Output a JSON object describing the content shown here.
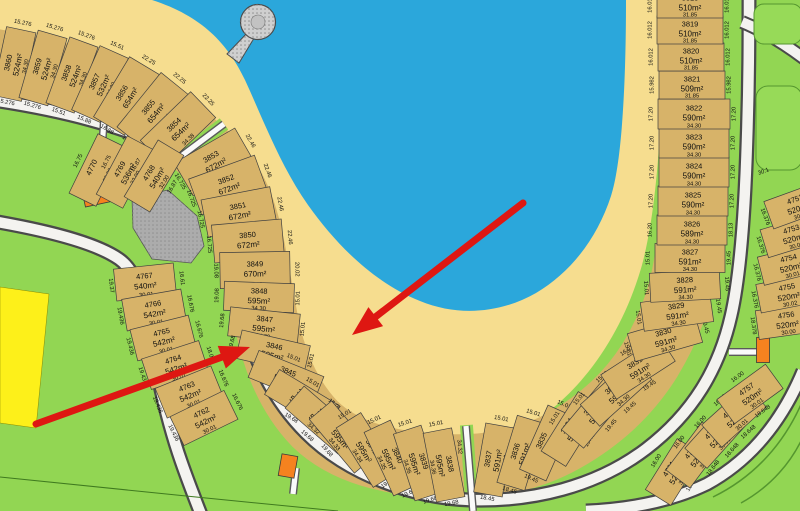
{
  "colors": {
    "lake": "#2BA7DB",
    "sand": "#F6DD8F",
    "lot_fill": "#D7B369",
    "grass": "#92D653",
    "road": "#F4F3F0",
    "road_casing": "#4A4A4A",
    "reserve_gray": "#ACACAC",
    "building_orange": "#F5821F",
    "stage_yellow": "#FDF01A",
    "annotation_red": "#DE1712",
    "text": "#101010"
  },
  "map": {
    "lots": [
      {
        "id": "3860",
        "area": "524m²",
        "dim": "34.30",
        "front": "15.276",
        "rear": "15.276",
        "x": 14,
        "y": 64,
        "r": -78,
        "w": 70,
        "h": 30,
        "fs": "r"
      },
      {
        "id": "3859",
        "area": "524m²",
        "dim": "34.30",
        "front": "15.276",
        "rear": "15.276",
        "x": 43,
        "y": 68,
        "r": -74,
        "w": 70,
        "h": 30,
        "fs": "r"
      },
      {
        "id": "3858",
        "area": "524m²",
        "dim": "34.30",
        "front": "15.276",
        "rear": "15.51",
        "x": 72,
        "y": 75,
        "r": -70,
        "w": 70,
        "h": 30,
        "fs": "r"
      },
      {
        "id": "3857",
        "area": "532m²",
        "dim": "34.30",
        "front": "15.51",
        "rear": "15.88",
        "x": 100,
        "y": 84,
        "r": -66,
        "w": 70,
        "h": 31,
        "fs": "r"
      },
      {
        "id": "3856",
        "area": "654m²",
        "dim": "34.31",
        "front": "22.25",
        "rear": "16.88",
        "x": 127,
        "y": 96,
        "r": -59,
        "w": 70,
        "h": 36,
        "fs": "r"
      },
      {
        "id": "3855",
        "area": "654m²",
        "dim": "34.34",
        "front": "22.25",
        "rear": "16.88",
        "x": 153,
        "y": 111,
        "r": -51,
        "w": 70,
        "h": 36,
        "fs": "r"
      },
      {
        "id": "3854",
        "area": "654m²",
        "dim": "34.38",
        "front": "22.25",
        "rear": "16.88",
        "x": 178,
        "y": 129,
        "r": -44,
        "w": 70,
        "h": 36,
        "fs": "r"
      },
      {
        "id": "3853",
        "area": "672m²",
        "dim": "34.30",
        "front": "22.46",
        "rear": "16.725",
        "x": 214,
        "y": 162,
        "r": -30,
        "w": 70,
        "h": 38,
        "fs": "r"
      },
      {
        "id": "3852",
        "area": "672m²",
        "dim": "34.30",
        "front": "22.46",
        "rear": "16.725",
        "x": 228,
        "y": 185,
        "r": -20,
        "w": 70,
        "h": 38,
        "fs": "r"
      },
      {
        "id": "3851",
        "area": "672m²",
        "dim": "34.30",
        "front": "22.46",
        "rear": "16.725",
        "x": 239,
        "y": 212,
        "r": -11,
        "w": 70,
        "h": 38,
        "fs": "r"
      },
      {
        "id": "3850",
        "area": "672m²",
        "dim": "34.30",
        "front": "22.46",
        "rear": "16.725",
        "x": 248,
        "y": 241,
        "r": -5,
        "w": 70,
        "h": 38,
        "fs": "r"
      },
      {
        "id": "3849",
        "area": "670m²",
        "dim": "34.30",
        "front": "20.02",
        "rear": "19.08",
        "x": 255,
        "y": 270,
        "r": -1,
        "w": 70,
        "h": 36,
        "fs": "r"
      },
      {
        "id": "3848",
        "area": "595m²",
        "dim": "34.30",
        "front": "15.01",
        "rear": "19.08",
        "x": 259,
        "y": 297,
        "r": 2,
        "w": 70,
        "h": 29,
        "fs": "r"
      },
      {
        "id": "3847",
        "area": "595m²",
        "dim": "34.30",
        "front": "15.01",
        "rear": "19.68",
        "x": 264,
        "y": 325,
        "r": 6,
        "w": 70,
        "h": 29,
        "fs": "r"
      },
      {
        "id": "3846",
        "area": "595m²",
        "dim": "34.31",
        "front": "15.01",
        "rear": "19.68",
        "x": 273,
        "y": 352,
        "r": 13,
        "w": 70,
        "h": 29,
        "fs": "r"
      },
      {
        "id": "3845",
        "area": "595m²",
        "dim": "34.31",
        "front": "15.01",
        "rear": "19.68",
        "x": 286,
        "y": 377,
        "r": 22,
        "w": 70,
        "h": 29,
        "fs": "t"
      },
      {
        "id": "3844",
        "area": "595m²",
        "dim": "34.31",
        "front": "15.01",
        "rear": "19.68",
        "x": 302,
        "y": 400,
        "r": 31,
        "w": 70,
        "h": 29,
        "fs": "t"
      },
      {
        "id": "3843",
        "area": "595m²",
        "dim": "34.32",
        "front": "15.01",
        "rear": "19.68",
        "x": 321,
        "y": 420,
        "r": 41,
        "w": 70,
        "h": 29,
        "fs": "t"
      },
      {
        "id": "3842",
        "area": "595m²",
        "dim": "34.33",
        "front": "15.01",
        "rear": "19.68",
        "x": 343,
        "y": 437,
        "r": 50,
        "w": 70,
        "h": 29,
        "fs": "t"
      },
      {
        "id": "3841",
        "area": "595m²",
        "dim": "34.34",
        "front": "15.01",
        "rear": "19.68",
        "x": 367,
        "y": 450,
        "r": 58,
        "w": 70,
        "h": 29,
        "fs": "l"
      },
      {
        "id": "3840",
        "area": "595m²",
        "dim": "34.35",
        "front": "15.01",
        "rear": "19.68",
        "x": 392,
        "y": 458,
        "r": 65,
        "w": 70,
        "h": 29,
        "fs": "l"
      },
      {
        "id": "3839",
        "area": "595m²",
        "dim": "34.36",
        "front": "15.01",
        "rear": "19.68",
        "x": 418,
        "y": 463,
        "r": 72,
        "w": 70,
        "h": 29,
        "fs": "l"
      },
      {
        "id": "3838",
        "area": "595m²",
        "dim": "34.36",
        "front": "15.01",
        "rear": "19.68",
        "x": 444,
        "y": 465,
        "r": 79,
        "w": 70,
        "h": 29,
        "fs": "l"
      },
      {
        "id": "3837",
        "area": "591m²",
        "dim": "34.30",
        "front": "15.01",
        "rear": "18.45",
        "x": 494,
        "y": 460,
        "r": -80,
        "w": 70,
        "h": 29,
        "fs": "r"
      },
      {
        "id": "3836",
        "area": "591m²",
        "dim": "34.30",
        "front": "15.01",
        "rear": "18.45",
        "x": 521,
        "y": 453,
        "r": -73,
        "w": 70,
        "h": 29,
        "fs": "r"
      },
      {
        "id": "3835",
        "area": "591m²",
        "dim": "34.30",
        "front": "15.01",
        "rear": "19.45",
        "x": 547,
        "y": 443,
        "r": -66,
        "w": 70,
        "h": 29,
        "fs": "r"
      },
      {
        "id": "3834",
        "area": "591m²",
        "dim": "34.30",
        "front": "15.01",
        "rear": "19.45",
        "x": 572,
        "y": 429,
        "r": -58,
        "w": 70,
        "h": 29,
        "fs": "t"
      },
      {
        "id": "3833",
        "area": "591m²",
        "dim": "34.30",
        "front": "15.01",
        "rear": "19.45",
        "x": 595,
        "y": 412,
        "r": -50,
        "w": 70,
        "h": 29,
        "fs": "t"
      },
      {
        "id": "3832",
        "area": "591m²",
        "dim": "34.30",
        "front": "15.01",
        "rear": "19.45",
        "x": 616,
        "y": 392,
        "r": -42,
        "w": 70,
        "h": 29,
        "fs": "t"
      },
      {
        "id": "3831",
        "area": "591m²",
        "dim": "34.30",
        "front": "16.01",
        "rear": "19.45",
        "x": 638,
        "y": 368,
        "r": -33,
        "w": 70,
        "h": 29,
        "fs": "t"
      },
      {
        "id": "3830",
        "area": "591m²",
        "dim": "34.30",
        "front": "15.01",
        "rear": "19.45",
        "x": 665,
        "y": 338,
        "r": -16,
        "w": 70,
        "h": 29,
        "fs": "l"
      },
      {
        "id": "3829",
        "area": "591m²",
        "dim": "34.30",
        "front": "15.01",
        "rear": "19.45",
        "x": 677,
        "y": 312,
        "r": -8,
        "w": 70,
        "h": 29,
        "fs": "l"
      },
      {
        "id": "3828",
        "area": "591m²",
        "dim": "34.30",
        "front": "15.01",
        "rear": "19.45",
        "x": 685,
        "y": 286,
        "r": -3,
        "w": 70,
        "h": 29,
        "fs": "l"
      },
      {
        "id": "3827",
        "area": "591m²",
        "dim": "34.30",
        "front": "15.01",
        "rear": "19.45",
        "x": 690,
        "y": 258,
        "r": 0,
        "w": 70,
        "h": 29,
        "fs": "l"
      },
      {
        "id": "3826",
        "area": "589m²",
        "dim": "34.30",
        "front": "16.20",
        "rear": "18.13",
        "x": 692,
        "y": 230,
        "r": 0,
        "w": 70,
        "h": 30,
        "fs": "l"
      },
      {
        "id": "3825",
        "area": "590m²",
        "dim": "34.30",
        "front": "17.20",
        "rear": "17.20",
        "x": 693,
        "y": 201,
        "r": 0,
        "w": 70,
        "h": 30,
        "fs": "l"
      },
      {
        "id": "3824",
        "area": "590m²",
        "dim": "34.30",
        "front": "17.20",
        "rear": "17.20",
        "x": 694,
        "y": 172,
        "r": 0,
        "w": 70,
        "h": 30,
        "fs": "l"
      },
      {
        "id": "3823",
        "area": "590m²",
        "dim": "34.30",
        "front": "17.20",
        "rear": "17.20",
        "x": 694,
        "y": 143,
        "r": 0,
        "w": 70,
        "h": 30,
        "fs": "l"
      },
      {
        "id": "3822",
        "area": "590m²",
        "dim": "34.30",
        "front": "17.20",
        "rear": "17.20",
        "x": 694,
        "y": 114,
        "r": 0,
        "w": 72,
        "h": 30,
        "fs": "l"
      },
      {
        "id": "3821",
        "area": "509m²",
        "dim": "31.85",
        "front": "15.982",
        "rear": "15.982",
        "x": 692,
        "y": 85,
        "r": 0,
        "w": 66,
        "h": 28,
        "fs": "l"
      },
      {
        "id": "3820",
        "area": "510m²",
        "dim": "31.85",
        "front": "16.012",
        "rear": "16.012",
        "x": 691,
        "y": 57,
        "r": 0,
        "w": 66,
        "h": 28,
        "fs": "l"
      },
      {
        "id": "3819",
        "area": "510m²",
        "dim": "31.85",
        "front": "16.012",
        "rear": "16.012",
        "x": 690,
        "y": 30,
        "r": 0,
        "w": 66,
        "h": 28,
        "fs": "l"
      },
      {
        "id": "3818",
        "area": "510m²",
        "dim": "31.85",
        "front": "16.012",
        "rear": "16.012",
        "x": 690,
        "y": 4,
        "r": 0,
        "w": 66,
        "h": 28,
        "fs": "l"
      },
      {
        "id": "4770",
        "area": "",
        "dim": "32.00",
        "front": "16.75",
        "rear": "16.75",
        "x": 97,
        "y": 170,
        "r": -64,
        "w": 66,
        "h": 30,
        "fs": "b"
      },
      {
        "id": "4769",
        "area": "536m²",
        "dim": "32.00",
        "front": "16.75",
        "rear": "16.75",
        "x": 125,
        "y": 172,
        "r": -62,
        "w": 66,
        "h": 30,
        "fs": "b"
      },
      {
        "id": "4768",
        "area": "540m²",
        "dim": "32.00",
        "front": "16.87",
        "rear": "16.87",
        "x": 154,
        "y": 176,
        "r": -59,
        "w": 66,
        "h": 30,
        "fs": "b"
      },
      {
        "id": "4767",
        "area": "540m²",
        "dim": "30.01",
        "front": "19.37",
        "rear": "16.61",
        "x": 145,
        "y": 282,
        "r": -6,
        "w": 60,
        "h": 32,
        "fs": "l"
      },
      {
        "id": "4766",
        "area": "542m²",
        "dim": "30.01",
        "front": "19.436",
        "rear": "16.676",
        "x": 154,
        "y": 310,
        "r": -10,
        "w": 60,
        "h": 32,
        "fs": "l"
      },
      {
        "id": "4765",
        "area": "542m²",
        "dim": "30.01",
        "front": "19.436",
        "rear": "16.676",
        "x": 163,
        "y": 338,
        "r": -14,
        "w": 60,
        "h": 32,
        "fs": "l"
      },
      {
        "id": "4764",
        "area": "542m²",
        "dim": "30.01",
        "front": "19.436",
        "rear": "18.07",
        "x": 175,
        "y": 365,
        "r": -18,
        "w": 60,
        "h": 32,
        "fs": "l"
      },
      {
        "id": "4763",
        "area": "542m²",
        "dim": "30.01",
        "front": "19.436",
        "rear": "16.676",
        "x": 189,
        "y": 392,
        "r": -22,
        "w": 60,
        "h": 32,
        "fs": "l"
      },
      {
        "id": "4762",
        "area": "542m²",
        "dim": "30.01",
        "front": "19.436",
        "rear": "16.676",
        "x": 204,
        "y": 418,
        "r": -26,
        "w": 60,
        "h": 32,
        "fs": "l"
      },
      {
        "id": "4761",
        "area": "520m²",
        "dim": "30.01",
        "front": "16.00",
        "rear": "18.648",
        "x": 674,
        "y": 472,
        "r": -58,
        "w": 60,
        "h": 30,
        "fs": "t"
      },
      {
        "id": "4760",
        "area": "520m²",
        "dim": "30.01",
        "front": "16.00",
        "rear": "18.648",
        "x": 696,
        "y": 455,
        "r": -53,
        "w": 60,
        "h": 30,
        "fs": "t"
      },
      {
        "id": "4759",
        "area": "520m²",
        "dim": "30.01",
        "front": "16.00",
        "rear": "18.648",
        "x": 716,
        "y": 436,
        "r": -48,
        "w": 60,
        "h": 30,
        "fs": "t"
      },
      {
        "id": "4758",
        "area": "520m²",
        "dim": "30.01",
        "front": "16.00",
        "rear": "18.648",
        "x": 734,
        "y": 416,
        "r": -42,
        "w": 60,
        "h": 30,
        "fs": "t"
      },
      {
        "id": "4757",
        "area": "520m²",
        "dim": "30.01",
        "front": "16.00",
        "rear": "18.648",
        "x": 750,
        "y": 394,
        "r": -36,
        "w": 60,
        "h": 30,
        "fs": "t"
      },
      {
        "id": "4756",
        "area": "520m²",
        "dim": "30.00",
        "front": "18.378",
        "x": 787,
        "y": 321,
        "r": -8,
        "w": 60,
        "h": 29,
        "fs": "l"
      },
      {
        "id": "4755",
        "area": "520m²",
        "dim": "30.02",
        "front": "16.376",
        "x": 788,
        "y": 293,
        "r": -11,
        "w": 60,
        "h": 29,
        "fs": "l"
      },
      {
        "id": "4754",
        "area": "520m²",
        "dim": "30.01",
        "front": "16.376",
        "x": 790,
        "y": 264,
        "r": -14,
        "w": 60,
        "h": 29,
        "fs": "l"
      },
      {
        "id": "4753",
        "area": "520m²",
        "dim": "30.01",
        "front": "16.376",
        "x": 793,
        "y": 235,
        "r": -17,
        "w": 60,
        "h": 29,
        "fs": "l"
      },
      {
        "id": "4752",
        "area": "520m²",
        "dim": "30.01",
        "front": "16.376",
        "x": 797,
        "y": 205,
        "r": -20,
        "w": 60,
        "h": 29,
        "fs": "l"
      }
    ],
    "extras": [
      {
        "t": "34.32",
        "x": 458,
        "y": 447,
        "r": 85
      },
      {
        "t": "30.1",
        "x": 764,
        "y": 173,
        "r": -20
      }
    ],
    "arrows": [
      {
        "x1": 523,
        "y1": 203,
        "x2": 352,
        "y2": 335
      },
      {
        "x1": 36,
        "y1": 424,
        "x2": 250,
        "y2": 347
      }
    ]
  }
}
